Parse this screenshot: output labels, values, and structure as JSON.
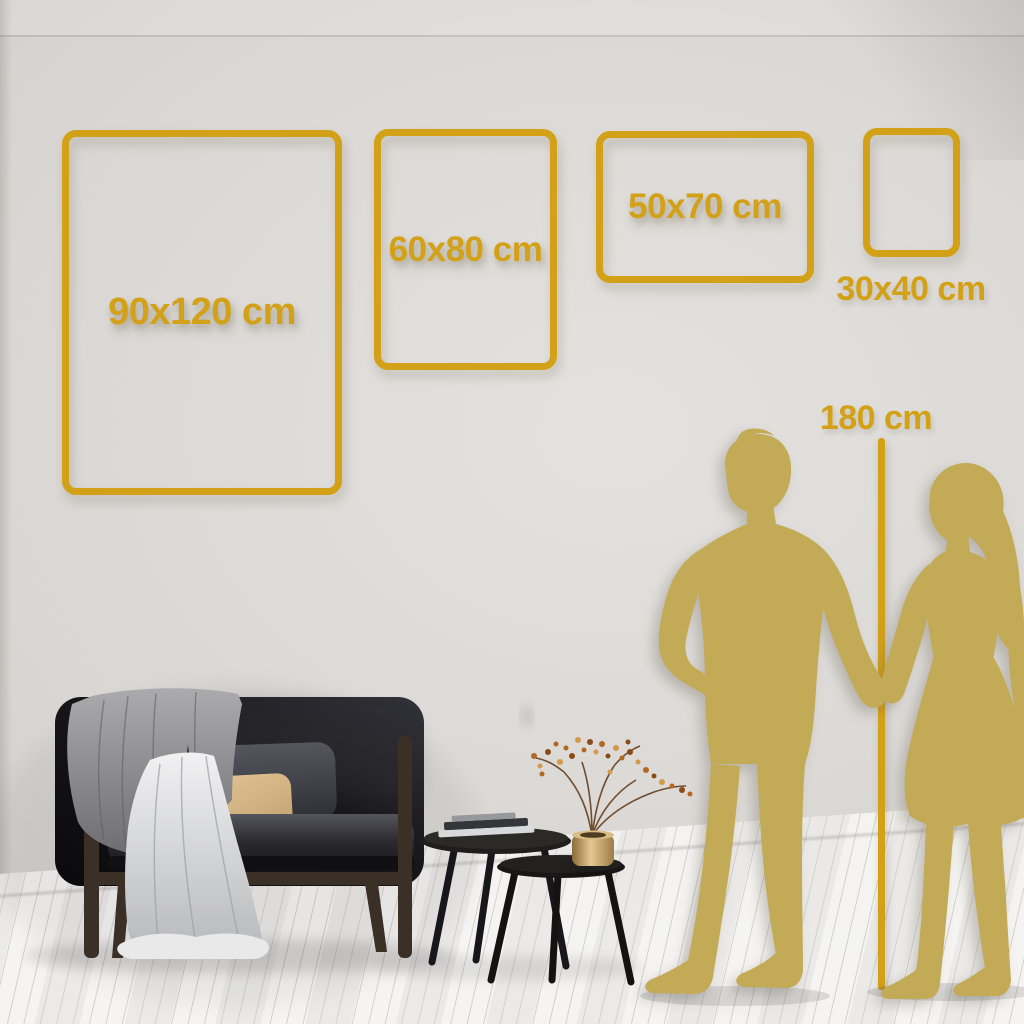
{
  "frames": [
    {
      "id": "90x120",
      "label": "90x120 cm",
      "orientation": "portrait"
    },
    {
      "id": "60x80",
      "label": "60x80 cm",
      "orientation": "portrait"
    },
    {
      "id": "50x70",
      "label": "50x70 cm",
      "orientation": "landscape"
    },
    {
      "id": "30x40",
      "label": "30x40 cm",
      "orientation": "portrait"
    }
  ],
  "height_reference": {
    "label": "180 cm"
  },
  "colors": {
    "gold": "#D3A118",
    "silhouette": "#C3AA57",
    "wall_light": "#E4E2DF",
    "wall_mid": "#D8D5D2",
    "wall_dark": "#C6C3C0",
    "floor": "#F1F0EE",
    "sofa": "#141417",
    "wood": "#3A3026",
    "pillow_tan": "#D9BA8A",
    "pillow_gray": "#45464C",
    "blanket": "#96969A",
    "cloth": "#E5E5E7",
    "table": "#1C1A18",
    "brass": "#C8A96E",
    "berry": "#B4671F"
  }
}
